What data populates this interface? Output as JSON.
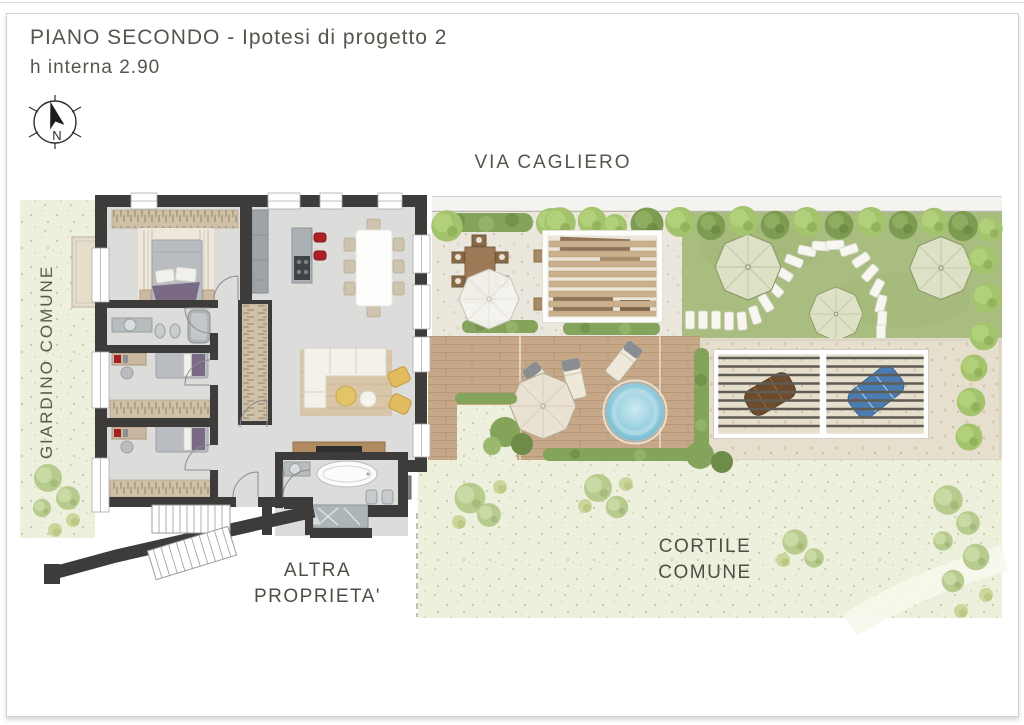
{
  "header": {
    "title": "PIANO SECONDO - Ipotesi di progetto 2",
    "subtitle": "h interna 2.90"
  },
  "compass": {
    "label": "N"
  },
  "labels": {
    "street": "VIA CAGLIERO",
    "left_garden": "GIARDINO COMUNE",
    "other_property": [
      "ALTRA",
      "PROPRIETA'"
    ],
    "courtyard": [
      "CORTILE",
      "COMUNE"
    ]
  },
  "colors": {
    "wall": "#3d3c3a",
    "floor": "#dcdcda",
    "lawn": "#a9bd80",
    "deck_wood": "#c6a788",
    "speckle_green": "#eef0de",
    "water_blue": "#8ecbdd",
    "stool_red": "#b01f24",
    "armchair_yellow": "#e3bb5f",
    "text": "#55544b"
  }
}
